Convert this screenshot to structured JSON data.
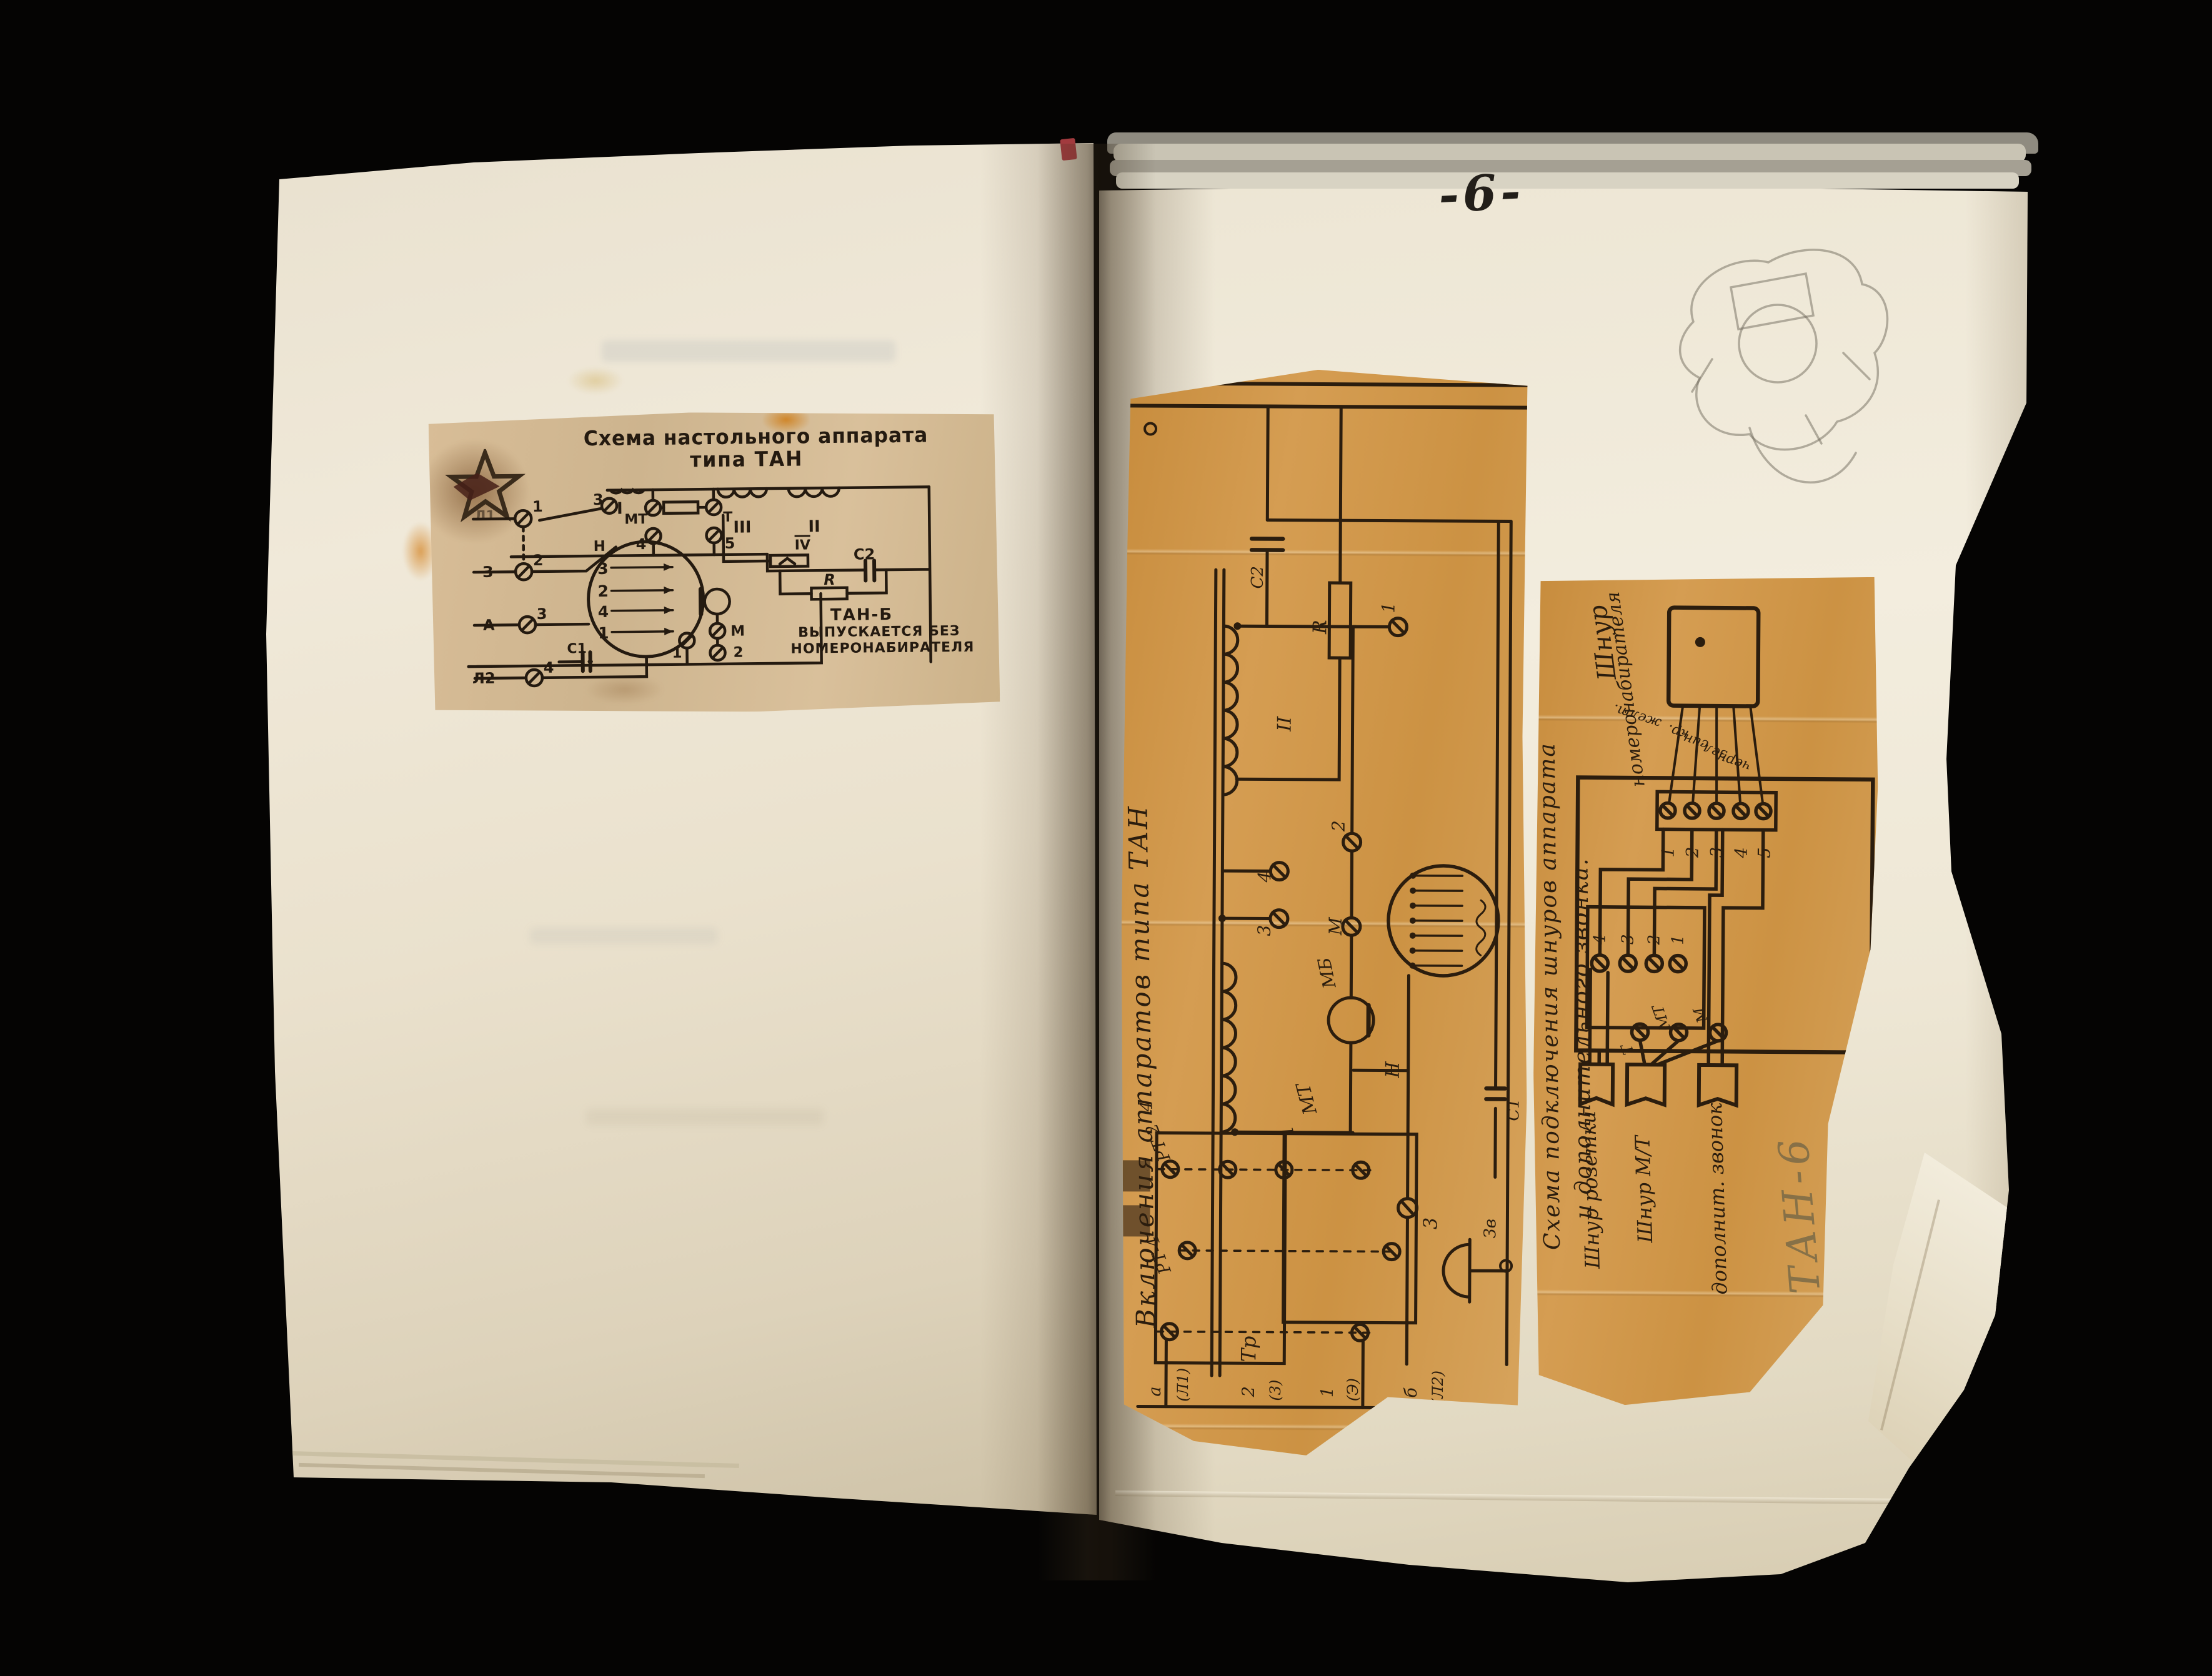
{
  "photo": {
    "page_number": "-6-"
  },
  "left_clipping": {
    "title_line1": "Схема настольного аппарата",
    "title_line2": "типа ТАН",
    "coils": [
      "I",
      "МТ",
      "Т",
      "III",
      "II"
    ],
    "top_screw_nums": [
      "3",
      "4",
      "5"
    ],
    "line_terminals": [
      {
        "label": "Л1",
        "num": "1"
      },
      {
        "label": "З",
        "num": "2"
      },
      {
        "label": "А",
        "num": "3"
      },
      {
        "label": "Л2",
        "num": "4"
      }
    ],
    "dial_numbers": [
      "3",
      "2",
      "4",
      "1"
    ],
    "component_labels": {
      "hook": "Н",
      "cap1": "С1",
      "cap2": "С2",
      "resistor": "R",
      "coil_iv": "IV",
      "mic": "М",
      "mic_terminal": "2",
      "bottom_terminal": "1"
    },
    "note_lines": [
      "ТАН-Б",
      "ВЫПУСКАЕТСЯ БЕЗ",
      "НОМЕРОНАБИРАТЕЛЯ"
    ]
  },
  "middle_clipping": {
    "title_vertical": "Включения аппаратов типа ТАН",
    "transformer": "Тр",
    "winding_labels": {
      "w2": "II",
      "wmt": "МТ",
      "w1": "1"
    },
    "screw_labels": {
      "s3": "3",
      "s4": "4",
      "line3": "3",
      "mic": "М",
      "t2": "2",
      "t1": "1"
    },
    "component_labels": {
      "handset": "МБ",
      "hook": "Н",
      "cap1": "С1",
      "cap2": "С2",
      "resistor": "R",
      "bell": "Зв"
    },
    "strip_labels": {
      "rt2": "РТ-2",
      "rt2_num": "4",
      "rt4": "РТ-4"
    },
    "bottom_terminals": [
      "а",
      "(Л1)",
      "2",
      "(3)",
      "1",
      "(Э)",
      "б",
      "(Л2)"
    ]
  },
  "right_clipping": {
    "title_line1": "Схема подключения шнуров аппарата",
    "title_line2": "и дополнительного звонка.",
    "dial_cord_line1": "Шнур",
    "dial_cord_line2": "номеронабирателя",
    "wire_colors": [
      "желт.",
      "кр.",
      "син.",
      "зел.",
      "черн."
    ],
    "strip_numbers": [
      "1",
      "2",
      "3",
      "4",
      "5"
    ],
    "inner_terminals": [
      "4",
      "3",
      "2",
      "1"
    ],
    "handset_terminals": [
      "Т",
      "МТ",
      "М"
    ],
    "cord_labels": [
      "Шнур розетки",
      "Шнур М/Т",
      "дополнит. звонок"
    ],
    "pencil_note": "ТАН-6"
  }
}
